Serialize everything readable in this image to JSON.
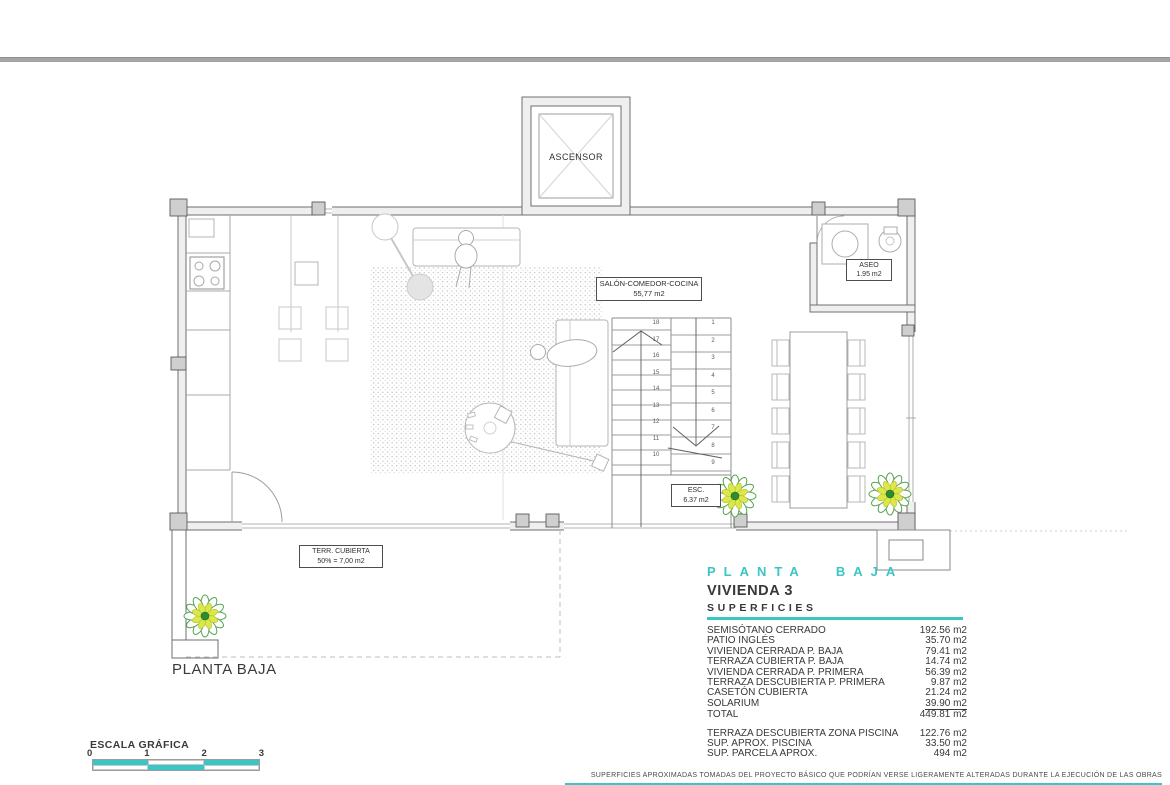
{
  "accent": "#3cc5c5",
  "plan": {
    "elevator": {
      "label": "ASCENSOR"
    },
    "salon": {
      "name": "SALÓN-COMEDOR-COCINA",
      "area": "55,77 m2"
    },
    "aseo": {
      "name": "ASEO",
      "area": "1.95 m2"
    },
    "stairs": {
      "name": "ESC.",
      "area": "6.37 m2",
      "right_steps": [
        "1",
        "2",
        "3",
        "4",
        "5",
        "6",
        "7",
        "8",
        "9"
      ],
      "left_steps": [
        "18",
        "17",
        "16",
        "15",
        "14",
        "13",
        "12",
        "11",
        "10"
      ]
    },
    "terrace": {
      "name": "TERR. CUBIERTA",
      "area": "50% = 7,00 m2"
    },
    "caption": "PLANTA BAJA"
  },
  "panel": {
    "floor_title": "PLANTA BAJA",
    "unit_title": "VIVIENDA 3",
    "section_title": "SUPERFICIES",
    "rows": [
      {
        "label": "SEMISÓTANO CERRADO",
        "value": "192.56 m2"
      },
      {
        "label": "PATIO INGLÉS",
        "value": "35.70 m2"
      },
      {
        "label": "VIVIENDA CERRADA P. BAJA",
        "value": "79.41 m2"
      },
      {
        "label": "TERRAZA CUBIERTA P. BAJA",
        "value": "14.74 m2"
      },
      {
        "label": "VIVIENDA CERRADA P. PRIMERA",
        "value": "56.39 m2"
      },
      {
        "label": "TERRAZA DESCUBIERTA P. PRIMERA",
        "value": "9.87 m2"
      },
      {
        "label": "CASETÓN CUBIERTA",
        "value": "21.24 m2"
      },
      {
        "label": "SOLARIUM",
        "value": "39.90 m2"
      },
      {
        "label": "TOTAL",
        "value": "449.81 m2"
      }
    ],
    "extra_rows": [
      {
        "label": "TERRAZA DESCUBIERTA ZONA PISCINA",
        "value": "122.76 m2"
      },
      {
        "label": "SUP. APROX. PISCINA",
        "value": "33.50 m2"
      },
      {
        "label": "SUP. PARCELA APROX.",
        "value": "494 m2"
      }
    ]
  },
  "scale_bar": {
    "title": "ESCALA GRÁFICA",
    "ticks": [
      "0",
      "1",
      "2",
      "3"
    ]
  },
  "footer": {
    "disclaimer": "SUPERFICIES APROXIMADAS TOMADAS DEL PROYECTO BÁSICO QUE PODRÍAN VERSE LIGERAMENTE ALTERADAS DURANTE LA EJECUCIÓN DE LAS OBRAS"
  }
}
